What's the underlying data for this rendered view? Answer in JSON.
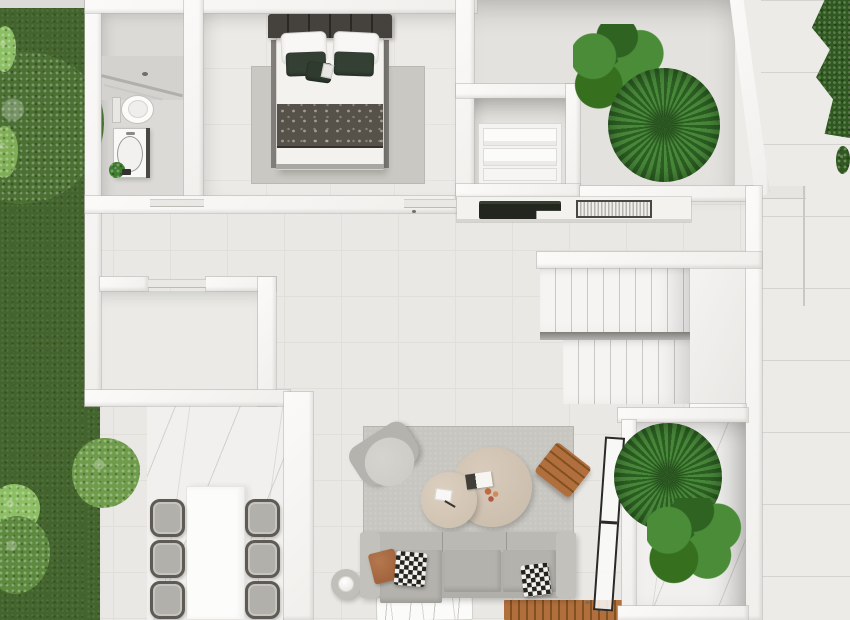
{
  "scene": {
    "title": "Top-down 3D architectural floor plan render",
    "style": "modern single-storey house with garden, patios and terraces",
    "text_on_screen": "none"
  },
  "palette": {
    "terrace": "#ecebe8",
    "wall": "#f7f6f5",
    "floor-main": "#e9e8e4",
    "floor-tile-line": "#e0dfda",
    "floor-bath": "#dbdad6",
    "floor-bed": "#eceae6",
    "floor-court": "#e3e2de",
    "marble": "#f1f0ee",
    "grass": "#43652d",
    "bush": "#6f9c4a",
    "bush-light": "#8cbf63",
    "hedge": "#30591f",
    "palm-dark": "#2c5e22",
    "palm-light": "#48883a",
    "leaf-dark": "#2f6322",
    "leaf-light": "#4a8c38",
    "rug": "#c8c6c0",
    "rug-bedroom": "#cac8c2",
    "sofa": "#b1afa9",
    "sofa-arm": "#c3c1bb",
    "cushion": "#b4b2ac",
    "headboard": "#403d39",
    "throw": "#56524a",
    "pillow-green": "#344033",
    "pillow-rust": "#a3653d",
    "checker-dark": "#26241f",
    "wood": "#b06f3d",
    "wood-dark": "#83501f",
    "table-beige": "#cdbfae",
    "table-beige-2": "#d0c3b2",
    "chair-frame": "#5e5a54",
    "chair-seat": "#b2b0ab",
    "white-furniture": "#fcfcfb",
    "counter-dark": "#2c3128",
    "glass-frame": "#2a2927",
    "stair-line": "#c9c8c5"
  },
  "areas": {
    "garden": {
      "name": "lawn garden",
      "elements": [
        "grass lawn",
        "large shrub",
        "round bush",
        "bright green tufts",
        "low bush"
      ]
    },
    "side_path": {
      "name": "right side path",
      "elements": [
        "stone path",
        "corner hedge"
      ]
    },
    "bathroom": {
      "name": "bathroom",
      "elements": [
        "walk-in shower with glass screen",
        "shower head",
        "toilet",
        "vanity with oval basin",
        "potted plant"
      ]
    },
    "bedroom": {
      "name": "bedroom",
      "elements": [
        "double bed",
        "panelled headboard",
        "white pillows",
        "dark green pillows",
        "accent cushion",
        "patterned throw blanket",
        "area rug"
      ]
    },
    "wardrobe": {
      "name": "wardrobe closet",
      "elements": [
        "open shelving",
        "folded linen stacks"
      ]
    },
    "patio_top": {
      "name": "upper patio planter",
      "elements": [
        "fiddle-leaf plant",
        "fan palm"
      ]
    },
    "hallway_kitchen": {
      "name": "hallway with wall kitchen",
      "elements": [
        "wall counter",
        "dark cooktop unit",
        "sink rack unit",
        "sliding doors"
      ]
    },
    "storage_room": {
      "name": "empty side room",
      "elements": []
    },
    "staircase": {
      "name": "two-flight staircase",
      "elements": [
        "upper flight",
        "mid landing",
        "lower flight"
      ]
    },
    "living_room": {
      "name": "living room",
      "elements": [
        "area rug",
        "sofa with chaise",
        "rust pillow",
        "checkered pillows",
        "armchair",
        "two round coffee tables",
        "books",
        "flower decor",
        "wood slat stool",
        "round side table with candle",
        "sketch rug",
        "wood deck mat",
        "black framed glass partition"
      ]
    },
    "dining_terrace": {
      "name": "marble dining terrace",
      "elements": [
        "rectangular white table",
        "six chairs"
      ]
    },
    "planter_patio": {
      "name": "lower patio planter",
      "elements": [
        "fan palm",
        "fiddle-leaf plant"
      ]
    }
  },
  "counts": {
    "dining_chairs": 6,
    "stair_treads_upper": 9,
    "stair_treads_lower": 8,
    "sofa_pillows": 3,
    "coffee_tables": 2,
    "bed_pillows": 4,
    "patio_plants_top": 2,
    "patio_plants_bottom": 2
  }
}
